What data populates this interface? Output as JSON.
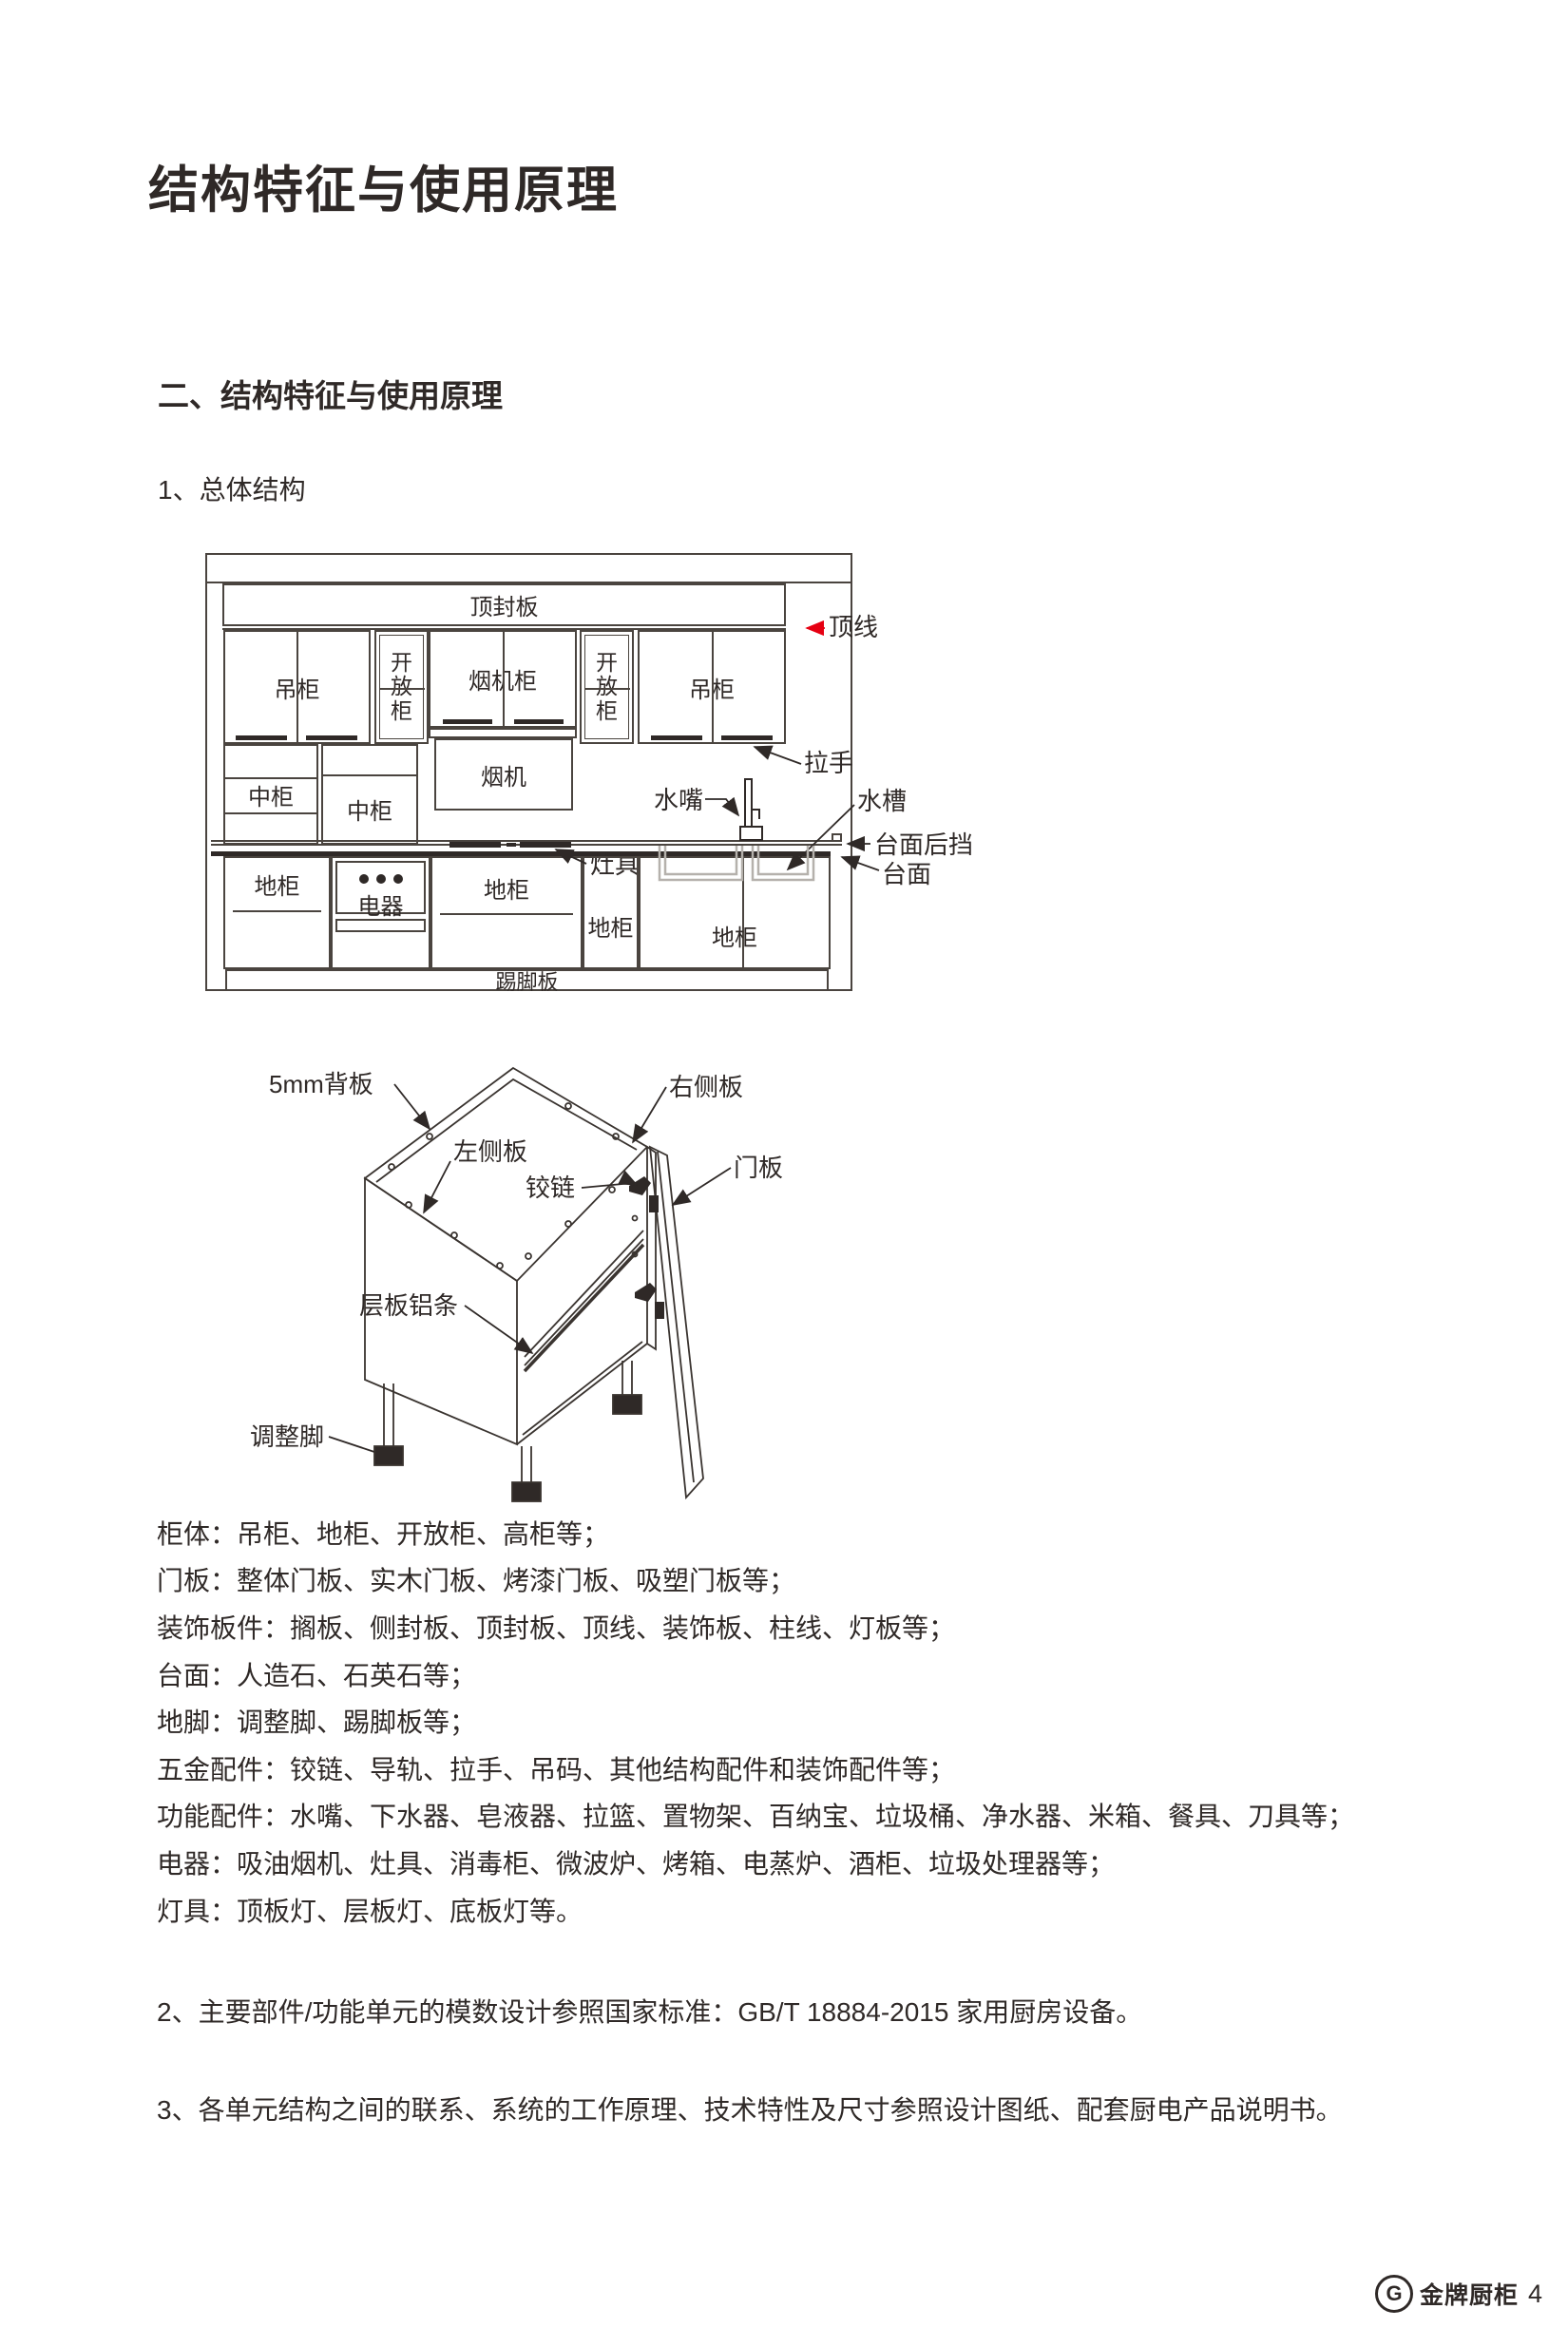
{
  "page": {
    "title": "结构特征与使用原理",
    "section_heading": "二、结构特征与使用原理",
    "subsection_heading": "1、总体结构"
  },
  "diagram1": {
    "top_board": "顶封板",
    "crown_line": "顶线",
    "wall_cabinet": "吊柜",
    "open_cabinet": "开放柜",
    "hood_cabinet": "烟机柜",
    "hood": "烟机",
    "handle": "拉手",
    "mid_cabinet": "中柜",
    "cooktop": "灶具",
    "faucet": "水嘴",
    "sink": "水槽",
    "counter_backstop": "台面后挡",
    "countertop": "台面",
    "base_cabinet": "地柜",
    "appliance": "电器",
    "kick_board": "踢脚板"
  },
  "diagram2": {
    "back_panel": "5mm背板",
    "right_side_panel": "右侧板",
    "left_side_panel": "左侧板",
    "hinge": "铰链",
    "door_panel": "门板",
    "shelf_aluminum_strip": "层板铝条",
    "adjustable_foot": "调整脚"
  },
  "component_list": [
    "柜体：吊柜、地柜、开放柜、高柜等；",
    "门板：整体门板、实木门板、烤漆门板、吸塑门板等；",
    "装饰板件：搁板、侧封板、顶封板、顶线、装饰板、柱线、灯板等；",
    "台面：人造石、石英石等；",
    "地脚：调整脚、踢脚板等；",
    "五金配件：铰链、导轨、拉手、吊码、其他结构配件和装饰配件等；",
    "功能配件：水嘴、下水器、皂液器、拉篮、置物架、百纳宝、垃圾桶、净水器、米箱、餐具、刀具等；",
    "电器：吸油烟机、灶具、消毒柜、微波炉、烤箱、电蒸炉、酒柜、垃圾处理器等；",
    "灯具：顶板灯、层板灯、底板灯等。"
  ],
  "paragraphs": {
    "p2": "2、主要部件/功能单元的模数设计参照国家标准：GB/T 18884-2015 家用厨房设备。",
    "p3": "3、各单元结构之间的联系、系统的工作原理、技术特性及尺寸参照设计图纸、配套厨电产品说明书。"
  },
  "footer": {
    "logo_letter": "G",
    "brand": "金牌厨柜",
    "page_number": "4"
  },
  "colors": {
    "ink": "#2f2927",
    "line": "#4a443f",
    "accent_red": "#e60012",
    "sink_gray": "#b5b1ac"
  }
}
